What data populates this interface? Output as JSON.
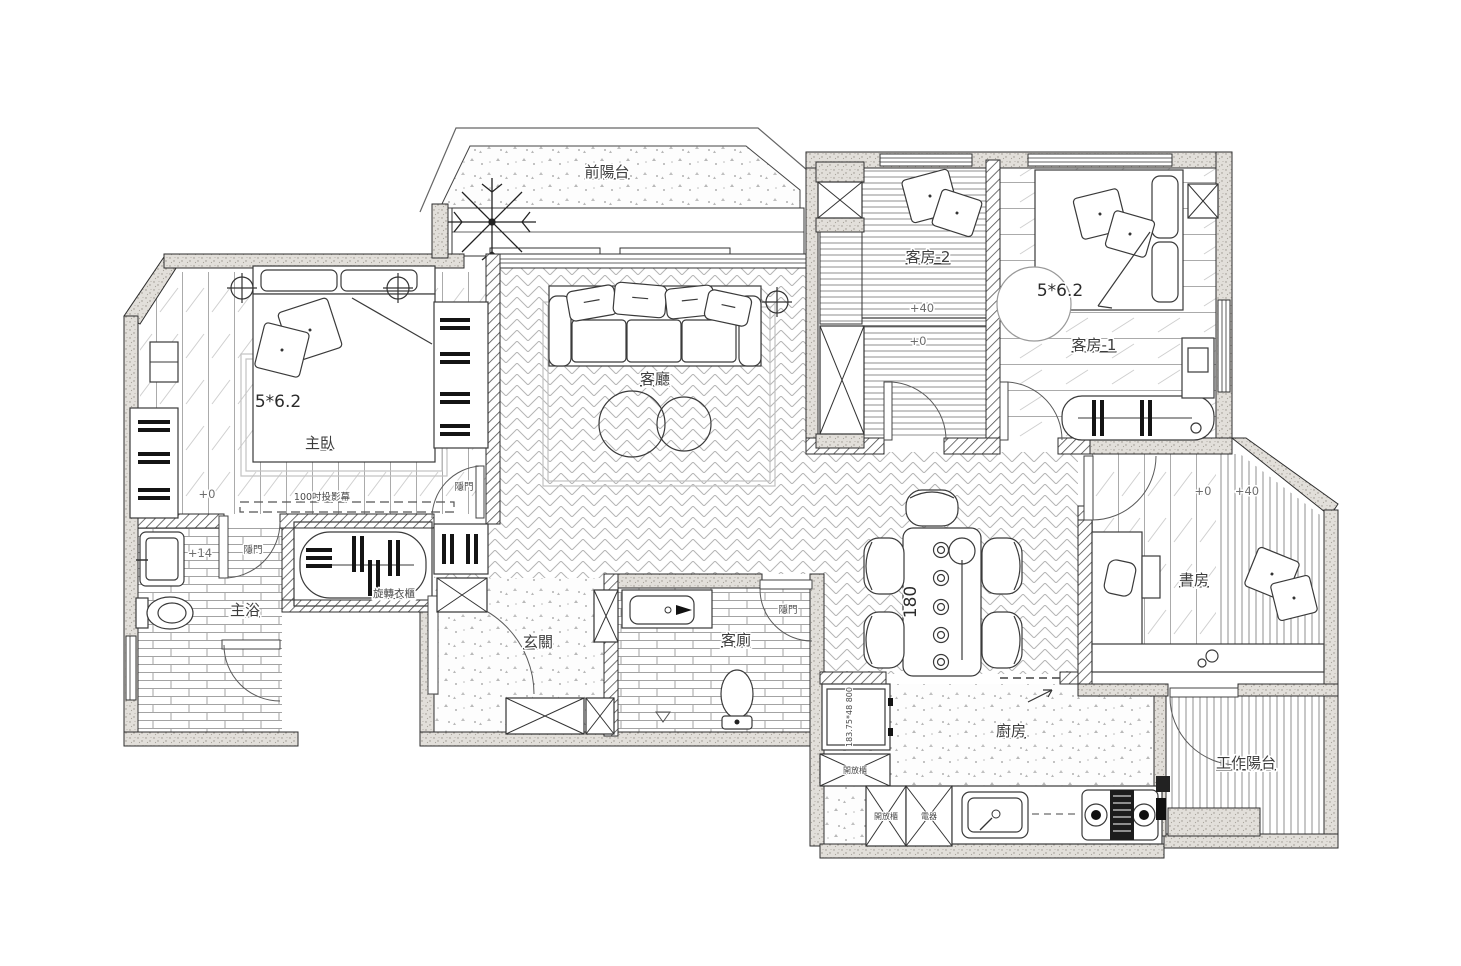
{
  "plan": {
    "labels": {
      "front_balcony": "前陽台",
      "living_room": "客廳",
      "master_bedroom": "主臥",
      "master_bath": "主浴",
      "entry": "玄關",
      "guest_wc": "客廁",
      "kitchen": "廚房",
      "study": "書房",
      "guest_room_1": "客房-1",
      "guest_room_2": "客房-2",
      "work_balcony": "工作陽台",
      "rotating_wardrobe": "旋轉衣櫃",
      "hidden_door": "隱門",
      "projector_screen": "100吋投影幕",
      "open_cabinet": "開放櫃",
      "appliances": "電器"
    },
    "dimensions": {
      "master_bed": "5*6.2",
      "guest_bed": "5*6.2",
      "dining_table": "180",
      "fridge": "183.75*48 800"
    },
    "levels": {
      "master_bedroom": "+0",
      "master_bath": "+14",
      "guest_room_2_platform": "+40",
      "guest_room_2_floor": "+0",
      "study_floor": "+0",
      "study_platform": "+40"
    }
  }
}
